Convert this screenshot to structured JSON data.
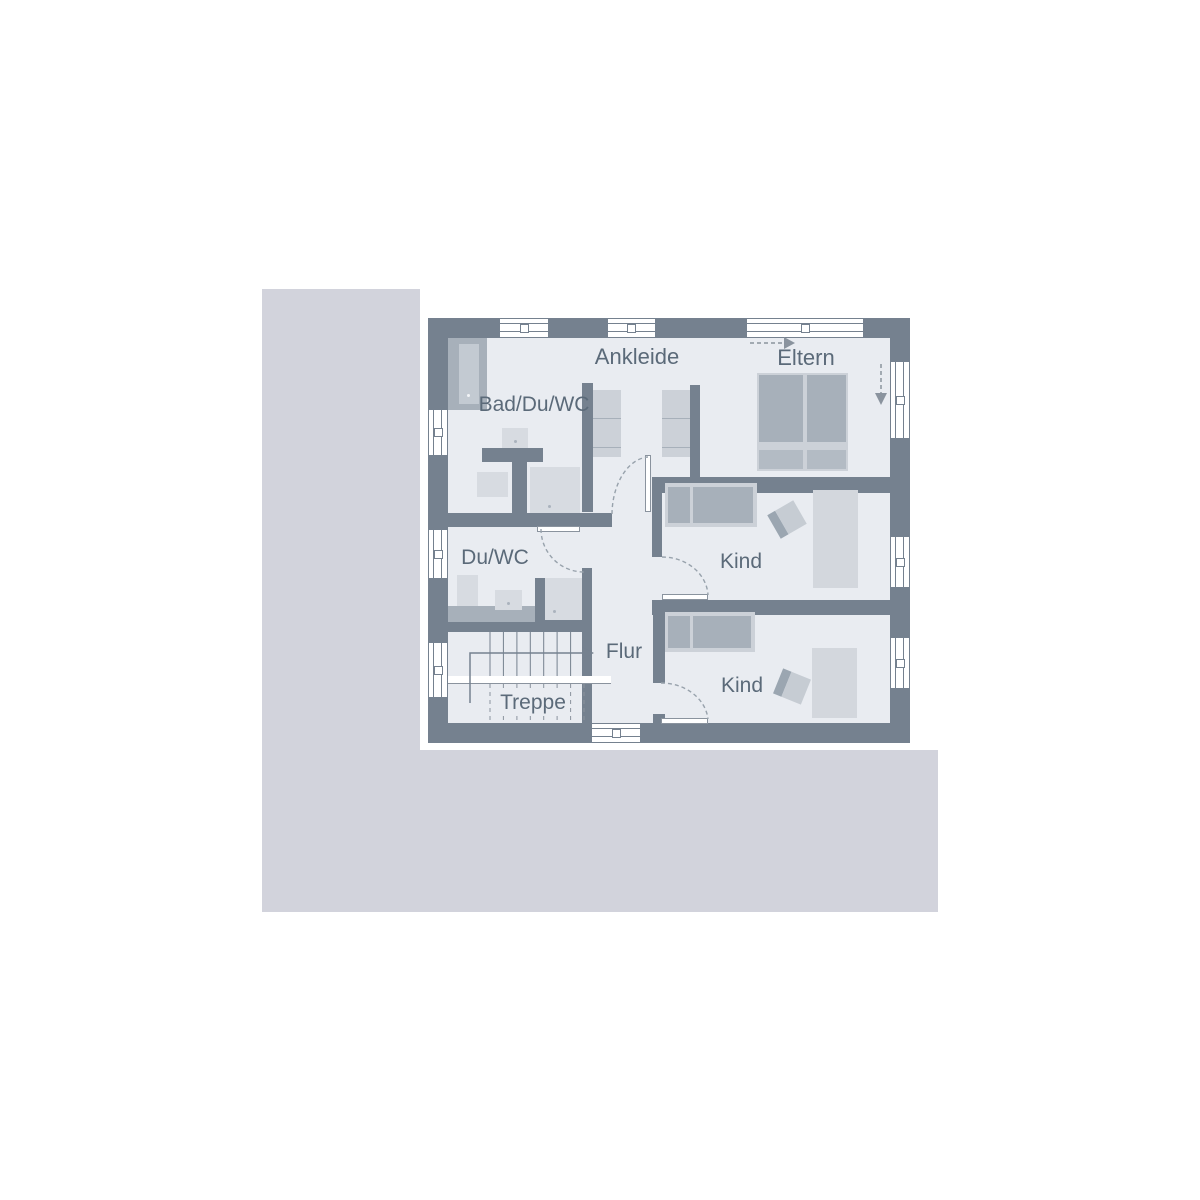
{
  "plan_title": "Obergeschoss Grundriss",
  "rooms": {
    "ankleide": {
      "label": "Ankleide"
    },
    "eltern": {
      "label": "Eltern"
    },
    "bad": {
      "label": "Bad/Du/WC"
    },
    "duwc": {
      "label": "Du/WC"
    },
    "flur": {
      "label": "Flur"
    },
    "treppe": {
      "label": "Treppe"
    },
    "kind1": {
      "label": "Kind"
    },
    "kind2": {
      "label": "Kind"
    }
  },
  "colors": {
    "site": "#d2d3dc",
    "floor": "#e9ecf1",
    "wall": "#75818f",
    "furniture_medium": "#a7b0ba",
    "furniture_light": "#ccd1d8",
    "fixture_light": "#d7dbe1",
    "bed_foot": "#b3bbc4",
    "label_text": "#5b6a79",
    "line_gray": "#8a939e"
  }
}
